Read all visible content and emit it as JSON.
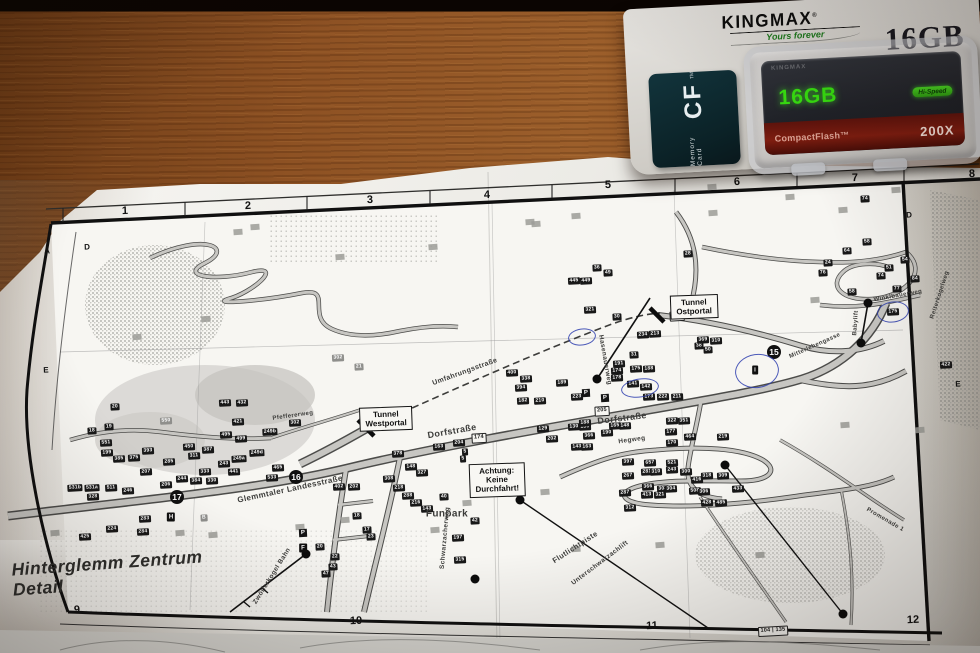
{
  "package": {
    "brand": "KINGMAX",
    "reg": "®",
    "tagline": "Yours forever",
    "capacity_print": "16GB",
    "side_label_small": "Memory Card",
    "side_label_big": "CF",
    "side_label_tm": "TM",
    "card_emboss": "KINGMAX",
    "card_capacity": "16GB",
    "card_speed_badge": "Hi-Speed",
    "card_type": "CompactFlash™",
    "card_speed": "200X"
  },
  "colors": {
    "pen_blue": "#2e3eaf",
    "card_green": "#37df10",
    "red_band": "#7e1d10",
    "wood": "#9c5f2b"
  },
  "map": {
    "title": "Hinterglemm Zentrum\nDetail",
    "grid": [
      {
        "x": 125,
        "y": 211,
        "t": "1"
      },
      {
        "x": 248,
        "y": 206,
        "t": "2"
      },
      {
        "x": 370,
        "y": 200,
        "t": "3"
      },
      {
        "x": 487,
        "y": 195,
        "t": "4"
      },
      {
        "x": 608,
        "y": 185,
        "t": "5"
      },
      {
        "x": 737,
        "y": 182,
        "t": "6"
      },
      {
        "x": 855,
        "y": 178,
        "t": "7"
      },
      {
        "x": 972,
        "y": 174,
        "t": "8"
      },
      {
        "x": 77,
        "y": 610,
        "t": "9"
      },
      {
        "x": 356,
        "y": 621,
        "t": "10"
      },
      {
        "x": 652,
        "y": 626,
        "t": "11"
      },
      {
        "x": 913,
        "y": 620,
        "t": "12"
      },
      {
        "x": 47,
        "y": 251,
        "t": "A",
        "c": "gl"
      },
      {
        "x": 87,
        "y": 247,
        "t": "D",
        "c": "gl"
      },
      {
        "x": 46,
        "y": 370,
        "t": "E",
        "c": "gl"
      },
      {
        "x": 909,
        "y": 215,
        "t": "D",
        "c": "gl"
      },
      {
        "x": 958,
        "y": 384,
        "t": "E",
        "c": "gl"
      }
    ],
    "boxes": [
      {
        "x": 694,
        "y": 307,
        "t": "Tunnel\nOstportal"
      },
      {
        "x": 386,
        "y": 419,
        "t": "Tunnel\nWestportal"
      },
      {
        "x": 497,
        "y": 480,
        "t": "Achtung:\nKeine Durchfahrt!"
      }
    ],
    "badges": [
      {
        "x": 774,
        "y": 352,
        "t": "15"
      },
      {
        "x": 296,
        "y": 477,
        "t": "16"
      },
      {
        "x": 177,
        "y": 497,
        "t": "17"
      }
    ],
    "streets": [
      {
        "x": 452,
        "y": 431,
        "t": "Dorfstraße",
        "r": -10,
        "s": 9
      },
      {
        "x": 622,
        "y": 418,
        "t": "Dorfstraße",
        "r": -7,
        "s": 9
      },
      {
        "x": 290,
        "y": 489,
        "t": "Glemmtaler Landesstraße",
        "r": -12,
        "s": 8
      },
      {
        "x": 465,
        "y": 372,
        "t": "Umfahrungsstraße",
        "r": -20,
        "s": 7
      },
      {
        "x": 445,
        "y": 538,
        "t": "Schwarzacherweg",
        "r": -85,
        "s": 6.5
      },
      {
        "x": 632,
        "y": 440,
        "t": "Hegweg",
        "r": -8,
        "s": 6.5
      },
      {
        "x": 605,
        "y": 360,
        "t": "Hasenauerweg",
        "r": 80,
        "s": 6.5
      },
      {
        "x": 272,
        "y": 576,
        "t": "Zwölferkogel Bahn",
        "r": -58,
        "s": 6.5
      },
      {
        "x": 447,
        "y": 514,
        "t": "Funpark",
        "r": 0,
        "s": 10
      },
      {
        "x": 575,
        "y": 547,
        "t": "Flutlichtpiste",
        "r": -33,
        "s": 7.5
      },
      {
        "x": 600,
        "y": 563,
        "t": "Unterschwarzachlift",
        "r": -37,
        "s": 6.5
      },
      {
        "x": 856,
        "y": 323,
        "t": "Babylift",
        "r": -86,
        "s": 6
      },
      {
        "x": 898,
        "y": 296,
        "t": "Winklbauerweg",
        "r": -10,
        "s": 6
      },
      {
        "x": 815,
        "y": 346,
        "t": "Mitterlehengasse",
        "r": -24,
        "s": 6
      },
      {
        "x": 293,
        "y": 416,
        "t": "Pfeffererweg",
        "r": -8,
        "s": 6
      },
      {
        "x": 885,
        "y": 520,
        "t": "Promenade 1",
        "r": 30,
        "s": 6
      },
      {
        "x": 940,
        "y": 295,
        "t": "Reiterkogelweg",
        "r": -72,
        "s": 6
      }
    ],
    "tags": [
      {
        "x": 92,
        "y": 431,
        "t": "18"
      },
      {
        "x": 109,
        "y": 427,
        "t": "19"
      },
      {
        "x": 115,
        "y": 407,
        "t": "20"
      },
      {
        "x": 106,
        "y": 443,
        "t": "551"
      },
      {
        "x": 107,
        "y": 453,
        "t": "199"
      },
      {
        "x": 119,
        "y": 459,
        "t": "385"
      },
      {
        "x": 134,
        "y": 458,
        "t": "375"
      },
      {
        "x": 148,
        "y": 451,
        "t": "393"
      },
      {
        "x": 146,
        "y": 472,
        "t": "207"
      },
      {
        "x": 75,
        "y": 488,
        "t": "531b"
      },
      {
        "x": 92,
        "y": 488,
        "t": "531a"
      },
      {
        "x": 111,
        "y": 488,
        "t": "511"
      },
      {
        "x": 128,
        "y": 491,
        "t": "246"
      },
      {
        "x": 93,
        "y": 497,
        "t": "328"
      },
      {
        "x": 166,
        "y": 485,
        "t": "206"
      },
      {
        "x": 182,
        "y": 479,
        "t": "244"
      },
      {
        "x": 169,
        "y": 462,
        "t": "285"
      },
      {
        "x": 189,
        "y": 447,
        "t": "450"
      },
      {
        "x": 194,
        "y": 456,
        "t": "311"
      },
      {
        "x": 208,
        "y": 450,
        "t": "387"
      },
      {
        "x": 196,
        "y": 481,
        "t": "384"
      },
      {
        "x": 212,
        "y": 481,
        "t": "330"
      },
      {
        "x": 205,
        "y": 472,
        "t": "333"
      },
      {
        "x": 224,
        "y": 464,
        "t": "243"
      },
      {
        "x": 234,
        "y": 472,
        "t": "441"
      },
      {
        "x": 239,
        "y": 459,
        "t": "249a"
      },
      {
        "x": 257,
        "y": 453,
        "t": "249d"
      },
      {
        "x": 270,
        "y": 432,
        "t": "249b"
      },
      {
        "x": 226,
        "y": 435,
        "t": "495"
      },
      {
        "x": 241,
        "y": 439,
        "t": "499"
      },
      {
        "x": 238,
        "y": 422,
        "t": "421"
      },
      {
        "x": 295,
        "y": 423,
        "t": "302"
      },
      {
        "x": 278,
        "y": 468,
        "t": "465"
      },
      {
        "x": 272,
        "y": 478,
        "t": "533"
      },
      {
        "x": 225,
        "y": 403,
        "t": "443"
      },
      {
        "x": 242,
        "y": 403,
        "t": "432"
      },
      {
        "x": 85,
        "y": 537,
        "t": "425"
      },
      {
        "x": 112,
        "y": 529,
        "t": "224"
      },
      {
        "x": 145,
        "y": 519,
        "t": "283"
      },
      {
        "x": 143,
        "y": 532,
        "t": "284"
      },
      {
        "x": 339,
        "y": 487,
        "t": "402"
      },
      {
        "x": 354,
        "y": 487,
        "t": "202"
      },
      {
        "x": 398,
        "y": 454,
        "t": "378"
      },
      {
        "x": 411,
        "y": 467,
        "t": "148"
      },
      {
        "x": 422,
        "y": 473,
        "t": "327"
      },
      {
        "x": 389,
        "y": 479,
        "t": "308"
      },
      {
        "x": 399,
        "y": 488,
        "t": "218"
      },
      {
        "x": 408,
        "y": 496,
        "t": "288"
      },
      {
        "x": 416,
        "y": 503,
        "t": "216"
      },
      {
        "x": 427,
        "y": 509,
        "t": "143"
      },
      {
        "x": 444,
        "y": 497,
        "t": "40"
      },
      {
        "x": 475,
        "y": 521,
        "t": "42"
      },
      {
        "x": 458,
        "y": 538,
        "t": "197"
      },
      {
        "x": 460,
        "y": 560,
        "t": "315"
      },
      {
        "x": 439,
        "y": 447,
        "t": "163"
      },
      {
        "x": 459,
        "y": 443,
        "t": "204"
      },
      {
        "x": 465,
        "y": 452,
        "t": "5"
      },
      {
        "x": 463,
        "y": 459,
        "t": "5"
      },
      {
        "x": 320,
        "y": 547,
        "t": "20"
      },
      {
        "x": 335,
        "y": 557,
        "t": "22"
      },
      {
        "x": 333,
        "y": 567,
        "t": "43"
      },
      {
        "x": 326,
        "y": 574,
        "t": "47"
      },
      {
        "x": 357,
        "y": 516,
        "t": "18"
      },
      {
        "x": 367,
        "y": 530,
        "t": "17"
      },
      {
        "x": 371,
        "y": 537,
        "t": "23"
      },
      {
        "x": 512,
        "y": 373,
        "t": "400"
      },
      {
        "x": 526,
        "y": 379,
        "t": "338"
      },
      {
        "x": 521,
        "y": 388,
        "t": "394"
      },
      {
        "x": 523,
        "y": 401,
        "t": "182"
      },
      {
        "x": 540,
        "y": 401,
        "t": "210"
      },
      {
        "x": 562,
        "y": 383,
        "t": "189"
      },
      {
        "x": 577,
        "y": 397,
        "t": "223"
      },
      {
        "x": 543,
        "y": 429,
        "t": "129"
      },
      {
        "x": 574,
        "y": 427,
        "t": "130"
      },
      {
        "x": 585,
        "y": 427,
        "t": "133"
      },
      {
        "x": 552,
        "y": 439,
        "t": "202"
      },
      {
        "x": 589,
        "y": 436,
        "t": "366"
      },
      {
        "x": 577,
        "y": 447,
        "t": "143"
      },
      {
        "x": 587,
        "y": 447,
        "t": "163"
      },
      {
        "x": 607,
        "y": 433,
        "t": "190"
      },
      {
        "x": 615,
        "y": 426,
        "t": "165"
      },
      {
        "x": 625,
        "y": 426,
        "t": "148"
      },
      {
        "x": 585,
        "y": 423,
        "t": "188"
      },
      {
        "x": 619,
        "y": 364,
        "t": "191"
      },
      {
        "x": 617,
        "y": 371,
        "t": "174"
      },
      {
        "x": 617,
        "y": 378,
        "t": "178"
      },
      {
        "x": 636,
        "y": 369,
        "t": "175"
      },
      {
        "x": 649,
        "y": 369,
        "t": "188"
      },
      {
        "x": 643,
        "y": 335,
        "t": "234"
      },
      {
        "x": 655,
        "y": 334,
        "t": "213"
      },
      {
        "x": 634,
        "y": 355,
        "t": "31"
      },
      {
        "x": 633,
        "y": 384,
        "t": "141"
      },
      {
        "x": 646,
        "y": 387,
        "t": "142"
      },
      {
        "x": 649,
        "y": 397,
        "t": "173"
      },
      {
        "x": 663,
        "y": 397,
        "t": "222"
      },
      {
        "x": 677,
        "y": 397,
        "t": "211"
      },
      {
        "x": 672,
        "y": 421,
        "t": "322"
      },
      {
        "x": 684,
        "y": 421,
        "t": "351"
      },
      {
        "x": 671,
        "y": 432,
        "t": "177"
      },
      {
        "x": 690,
        "y": 437,
        "t": "464"
      },
      {
        "x": 672,
        "y": 443,
        "t": "170"
      },
      {
        "x": 723,
        "y": 437,
        "t": "219"
      },
      {
        "x": 699,
        "y": 346,
        "t": "38"
      },
      {
        "x": 708,
        "y": 350,
        "t": "50"
      },
      {
        "x": 703,
        "y": 340,
        "t": "369"
      },
      {
        "x": 716,
        "y": 341,
        "t": "310"
      },
      {
        "x": 597,
        "y": 268,
        "t": "36"
      },
      {
        "x": 608,
        "y": 273,
        "t": "49"
      },
      {
        "x": 574,
        "y": 281,
        "t": "445"
      },
      {
        "x": 586,
        "y": 281,
        "t": "449"
      },
      {
        "x": 590,
        "y": 310,
        "t": "321"
      },
      {
        "x": 617,
        "y": 317,
        "t": "30"
      },
      {
        "x": 688,
        "y": 254,
        "t": "28"
      },
      {
        "x": 865,
        "y": 199,
        "t": "74"
      },
      {
        "x": 867,
        "y": 242,
        "t": "58"
      },
      {
        "x": 847,
        "y": 251,
        "t": "64"
      },
      {
        "x": 905,
        "y": 260,
        "t": "54"
      },
      {
        "x": 889,
        "y": 268,
        "t": "51"
      },
      {
        "x": 881,
        "y": 276,
        "t": "74"
      },
      {
        "x": 915,
        "y": 279,
        "t": "84"
      },
      {
        "x": 897,
        "y": 289,
        "t": "77"
      },
      {
        "x": 828,
        "y": 263,
        "t": "24"
      },
      {
        "x": 823,
        "y": 273,
        "t": "76"
      },
      {
        "x": 852,
        "y": 292,
        "t": "58"
      },
      {
        "x": 893,
        "y": 312,
        "t": "175"
      },
      {
        "x": 946,
        "y": 365,
        "t": "422"
      },
      {
        "x": 628,
        "y": 462,
        "t": "397"
      },
      {
        "x": 650,
        "y": 463,
        "t": "657"
      },
      {
        "x": 672,
        "y": 463,
        "t": "521"
      },
      {
        "x": 628,
        "y": 476,
        "t": "267"
      },
      {
        "x": 647,
        "y": 472,
        "t": "281"
      },
      {
        "x": 656,
        "y": 472,
        "t": "310"
      },
      {
        "x": 672,
        "y": 470,
        "t": "243"
      },
      {
        "x": 686,
        "y": 472,
        "t": "300"
      },
      {
        "x": 697,
        "y": 480,
        "t": "416"
      },
      {
        "x": 707,
        "y": 476,
        "t": "318"
      },
      {
        "x": 723,
        "y": 476,
        "t": "309"
      },
      {
        "x": 648,
        "y": 487,
        "t": "366"
      },
      {
        "x": 663,
        "y": 489,
        "t": "303"
      },
      {
        "x": 671,
        "y": 489,
        "t": "304"
      },
      {
        "x": 695,
        "y": 491,
        "t": "508"
      },
      {
        "x": 704,
        "y": 492,
        "t": "306"
      },
      {
        "x": 738,
        "y": 489,
        "t": "433"
      },
      {
        "x": 647,
        "y": 495,
        "t": "413"
      },
      {
        "x": 660,
        "y": 495,
        "t": "321"
      },
      {
        "x": 707,
        "y": 503,
        "t": "428"
      },
      {
        "x": 721,
        "y": 503,
        "t": "485"
      },
      {
        "x": 630,
        "y": 508,
        "t": "312"
      },
      {
        "x": 625,
        "y": 493,
        "t": "287"
      },
      {
        "x": 166,
        "y": 421,
        "t": "550",
        "c": "g"
      },
      {
        "x": 338,
        "y": 358,
        "t": "302",
        "c": "g"
      },
      {
        "x": 359,
        "y": 367,
        "t": "21",
        "c": "g"
      },
      {
        "x": 204,
        "y": 518,
        "t": "B",
        "c": "g"
      },
      {
        "x": 479,
        "y": 438,
        "t": "174",
        "c": "w"
      },
      {
        "x": 602,
        "y": 411,
        "t": "205",
        "c": "w"
      },
      {
        "x": 677,
        "y": 316,
        "t": "467",
        "c": "w"
      },
      {
        "x": 773,
        "y": 631,
        "t": "104 | 135",
        "c": "w"
      }
    ],
    "squares": [
      {
        "x": 137,
        "y": 337
      },
      {
        "x": 238,
        "y": 232
      },
      {
        "x": 206,
        "y": 319
      },
      {
        "x": 255,
        "y": 227
      },
      {
        "x": 340,
        "y": 257
      },
      {
        "x": 433,
        "y": 247
      },
      {
        "x": 530,
        "y": 222
      },
      {
        "x": 576,
        "y": 216
      },
      {
        "x": 536,
        "y": 224
      },
      {
        "x": 713,
        "y": 213
      },
      {
        "x": 790,
        "y": 197
      },
      {
        "x": 843,
        "y": 210
      },
      {
        "x": 896,
        "y": 190
      },
      {
        "x": 712,
        "y": 187
      },
      {
        "x": 467,
        "y": 503
      },
      {
        "x": 545,
        "y": 492
      },
      {
        "x": 576,
        "y": 549
      },
      {
        "x": 55,
        "y": 533
      },
      {
        "x": 180,
        "y": 533
      },
      {
        "x": 213,
        "y": 535
      },
      {
        "x": 300,
        "y": 527
      },
      {
        "x": 345,
        "y": 520
      },
      {
        "x": 435,
        "y": 530
      },
      {
        "x": 660,
        "y": 545
      },
      {
        "x": 760,
        "y": 555
      },
      {
        "x": 845,
        "y": 425
      },
      {
        "x": 920,
        "y": 430
      },
      {
        "x": 815,
        "y": 300
      }
    ],
    "dots": [
      {
        "x": 597,
        "y": 379
      },
      {
        "x": 306,
        "y": 554
      },
      {
        "x": 520,
        "y": 500
      },
      {
        "x": 843,
        "y": 614
      },
      {
        "x": 868,
        "y": 303
      },
      {
        "x": 861,
        "y": 343
      },
      {
        "x": 725,
        "y": 465
      },
      {
        "x": 475,
        "y": 579
      }
    ],
    "parking": [
      {
        "x": 586,
        "y": 393,
        "t": "P"
      },
      {
        "x": 605,
        "y": 398,
        "t": "P"
      },
      {
        "x": 303,
        "y": 533,
        "t": "P"
      }
    ],
    "minicons": [
      {
        "x": 755,
        "y": 370,
        "t": "i"
      },
      {
        "x": 171,
        "y": 517,
        "t": "H"
      },
      {
        "x": 303,
        "y": 548,
        "t": "F"
      }
    ],
    "pens": [
      {
        "x": 582,
        "y": 337,
        "w": 26,
        "h": 15
      },
      {
        "x": 640,
        "y": 388,
        "w": 36,
        "h": 17
      },
      {
        "x": 757,
        "y": 371,
        "w": 42,
        "h": 32
      },
      {
        "x": 893,
        "y": 312,
        "w": 30,
        "h": 19
      }
    ]
  }
}
